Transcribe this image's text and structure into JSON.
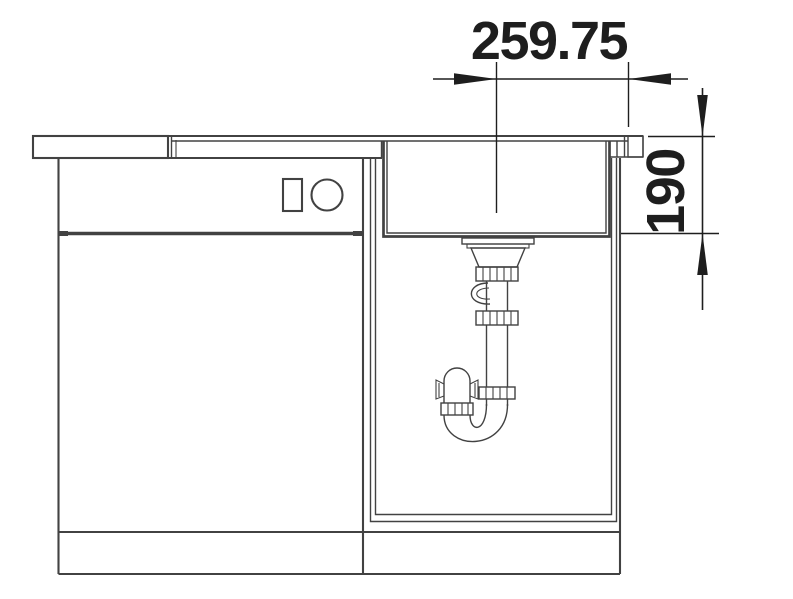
{
  "dimensions": {
    "width_mm": "259.75",
    "depth_mm": "190"
  },
  "colors": {
    "background": "#ffffff",
    "line": "#424242",
    "dimension": "#1e1e1e"
  }
}
